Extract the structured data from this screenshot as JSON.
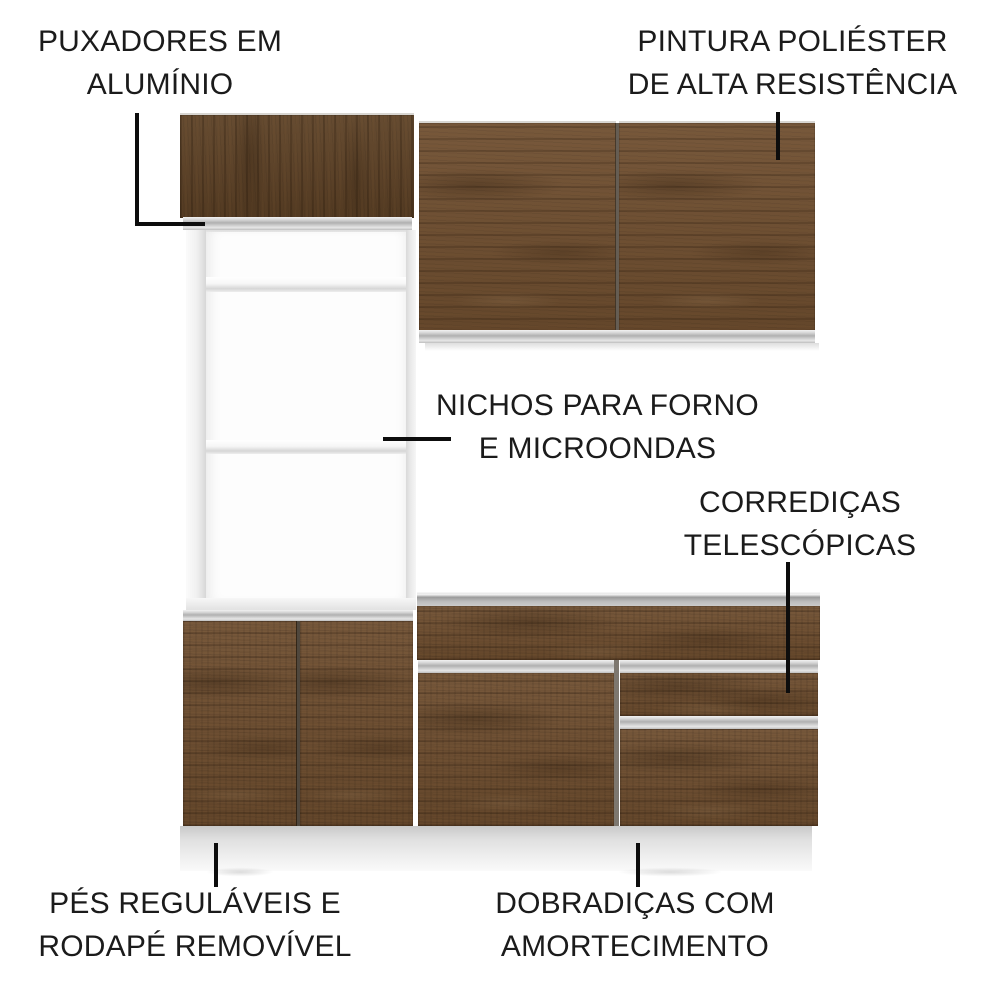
{
  "diagram": {
    "labels": {
      "handles": {
        "line1": "PUXADORES EM",
        "line2": "ALUMÍNIO"
      },
      "paint": {
        "line1": "PINTURA POLIÉSTER",
        "line2": "DE ALTA RESISTÊNCIA"
      },
      "niches": {
        "line1": "NICHOS PARA FORNO",
        "line2": "E MICROONDAS"
      },
      "slides": {
        "line1": "CORREDIÇAS",
        "line2": "TELESCÓPICAS"
      },
      "feet": {
        "line1": "PÉS REGULÁVEIS E",
        "line2": "RODAPÉ REMOVÍVEL"
      },
      "hinges": {
        "line1": "DOBRADIÇAS COM",
        "line2": "AMORTECIMENTO"
      }
    },
    "colors": {
      "background": "#ffffff",
      "text": "#1b1b1b",
      "callout_line": "#0d0d0d",
      "wood_base": "#6f4e2f",
      "wood_dark": "#5e4226",
      "aluminum": "#c9c9c9",
      "frame_white": "#f4f4f4",
      "plinth_gray": "#e3e3e3"
    }
  }
}
